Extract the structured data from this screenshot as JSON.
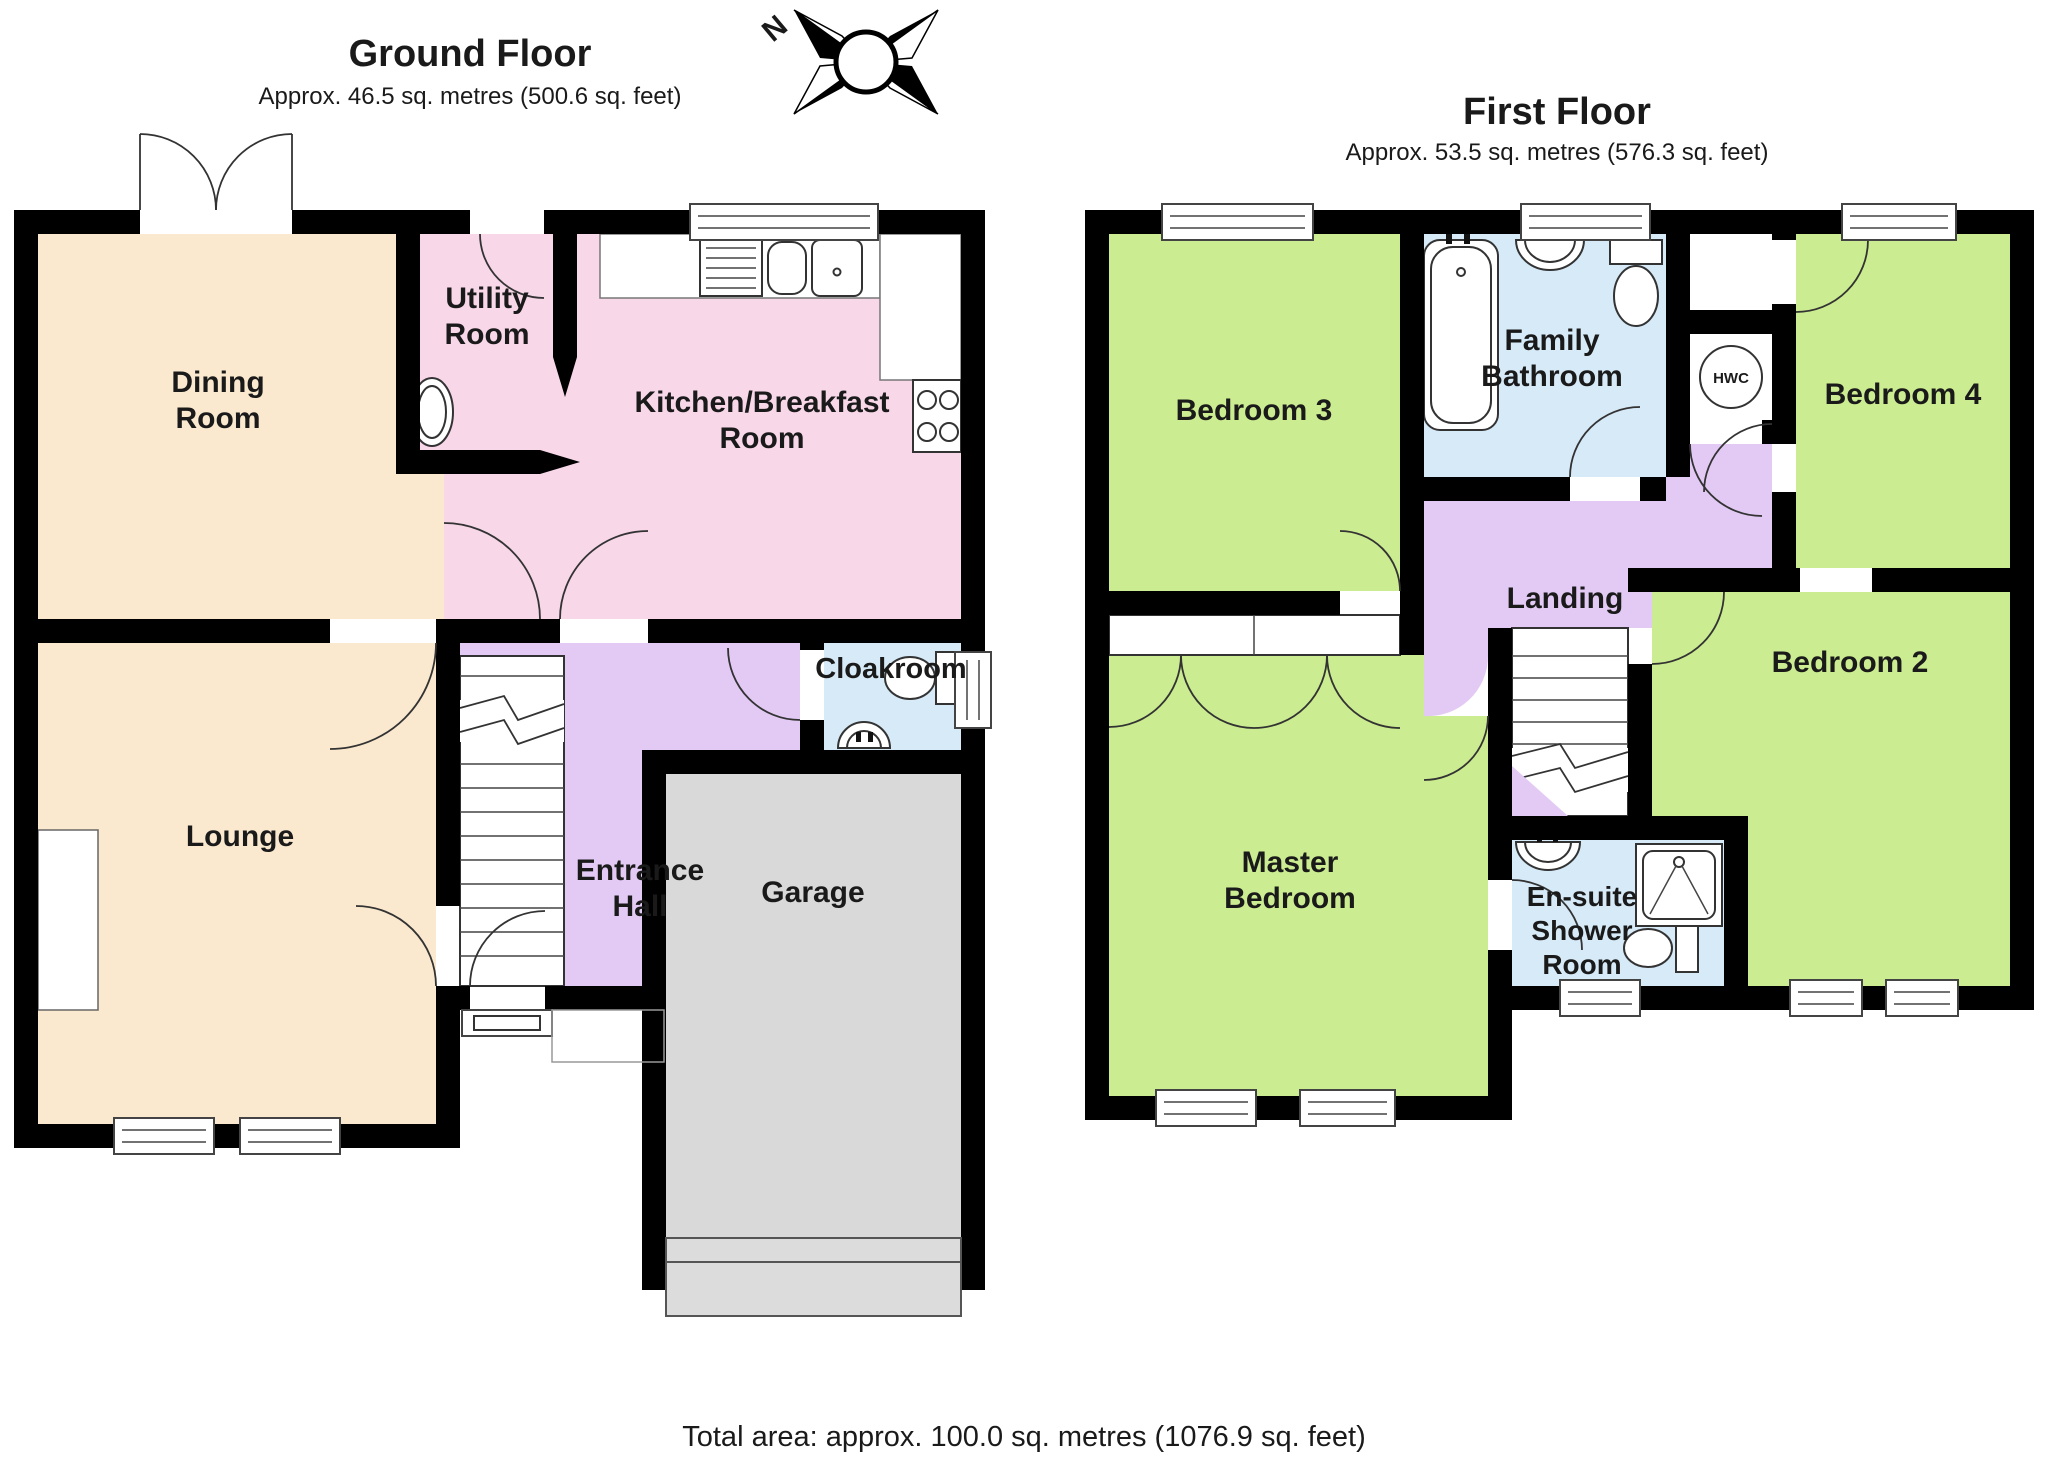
{
  "ground_floor": {
    "title": "Ground Floor",
    "subtitle": "Approx. 46.5 sq. metres (500.6 sq. feet)",
    "rooms": [
      {
        "name": "Dining Room",
        "label_lines": [
          "Dining",
          "Room"
        ]
      },
      {
        "name": "Utility Room",
        "label_lines": [
          "Utility",
          "Room"
        ]
      },
      {
        "name": "Kitchen/Breakfast Room",
        "label_lines": [
          "Kitchen/Breakfast",
          "Room"
        ]
      },
      {
        "name": "Cloakroom",
        "label_lines": [
          "Cloakroom"
        ]
      },
      {
        "name": "Lounge",
        "label_lines": [
          "Lounge"
        ]
      },
      {
        "name": "Entrance Hall",
        "label_lines": [
          "Entrance",
          "Hall"
        ]
      },
      {
        "name": "Garage",
        "label_lines": [
          "Garage"
        ]
      }
    ]
  },
  "first_floor": {
    "title": "First Floor",
    "subtitle": "Approx. 53.5 sq. metres (576.3 sq. feet)",
    "hwc_label": "HWC",
    "rooms": [
      {
        "name": "Bedroom 3",
        "label_lines": [
          "Bedroom 3"
        ]
      },
      {
        "name": "Family Bathroom",
        "label_lines": [
          "Family",
          "Bathroom"
        ]
      },
      {
        "name": "Bedroom 4",
        "label_lines": [
          "Bedroom 4"
        ]
      },
      {
        "name": "Landing",
        "label_lines": [
          "Landing"
        ]
      },
      {
        "name": "Master Bedroom",
        "label_lines": [
          "Master",
          "Bedroom"
        ]
      },
      {
        "name": "En-suite Shower Room",
        "label_lines": [
          "En-suite",
          "Shower",
          "Room"
        ]
      },
      {
        "name": "Bedroom 2",
        "label_lines": [
          "Bedroom 2"
        ]
      }
    ]
  },
  "compass": {
    "label": "N"
  },
  "footer": {
    "total_area": "Total area: approx. 100.0 sq. metres (1076.9 sq. feet)"
  },
  "colors": {
    "wall": "#000000",
    "cream": "#FAE9CF",
    "pink": "#F8D7E9",
    "lilac": "#E3CAF4",
    "blue": "#D6EAF8",
    "green": "#CBEC90",
    "gray": "#D9D9D9",
    "garage_door": "#DCDCDC",
    "text": "#1A1A1A"
  }
}
